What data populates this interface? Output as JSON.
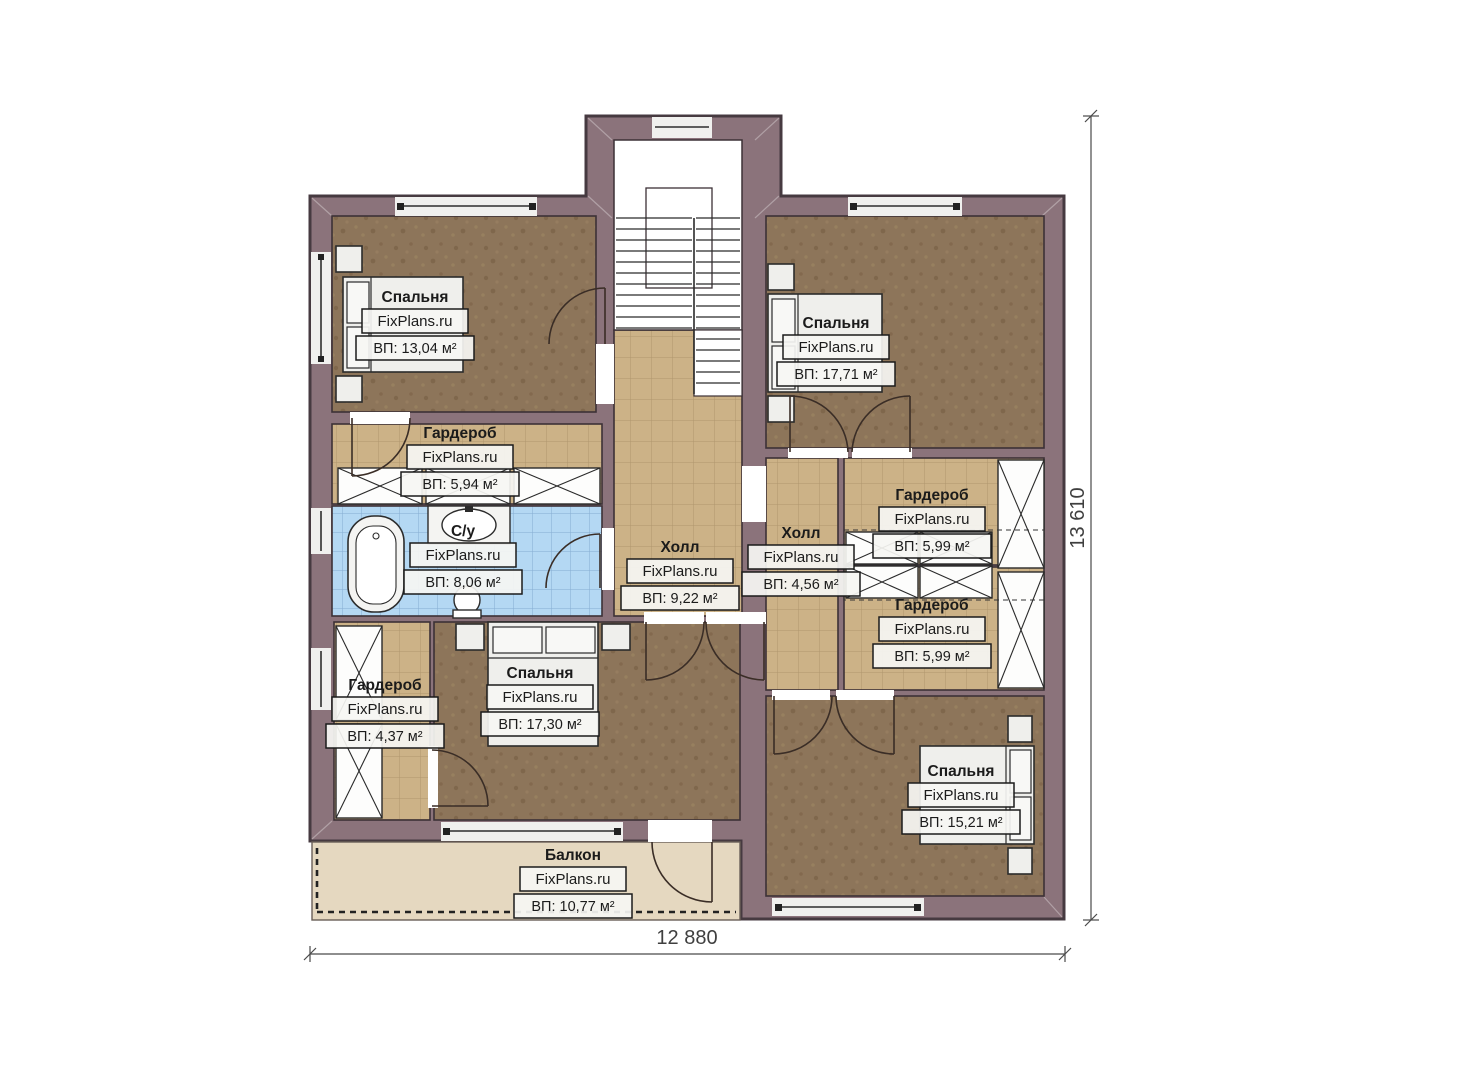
{
  "plan": {
    "brand": "FixPlans.ru",
    "dimensions": {
      "width_label": "12 880",
      "height_label": "13 610"
    },
    "rooms": [
      {
        "id": "bedroom-top-left",
        "name": "Спальня",
        "area": "ВП: 13,04 м²"
      },
      {
        "id": "wardrobe-left",
        "name": "Гардероб",
        "area": "ВП: 5,94 м²"
      },
      {
        "id": "bathroom",
        "name": "С/у",
        "area": "ВП: 8,06 м²"
      },
      {
        "id": "hall-center",
        "name": "Холл",
        "area": "ВП: 9,22 м²"
      },
      {
        "id": "hall-right",
        "name": "Холл",
        "area": "ВП: 4,56 м²"
      },
      {
        "id": "wardrobe-right-upper",
        "name": "Гардероб",
        "area": "ВП: 5,99 м²"
      },
      {
        "id": "wardrobe-right-lower",
        "name": "Гардероб",
        "area": "ВП: 5,99 м²"
      },
      {
        "id": "bedroom-top-right",
        "name": "Спальня",
        "area": "ВП: 17,71 м²"
      },
      {
        "id": "wardrobe-bottom-left",
        "name": "Гардероб",
        "area": "ВП: 4,37 м²"
      },
      {
        "id": "bedroom-bottom-center",
        "name": "Спальня",
        "area": "ВП: 17,30 м²"
      },
      {
        "id": "bedroom-bottom-right",
        "name": "Спальня",
        "area": "ВП: 15,21 м²"
      },
      {
        "id": "balcony",
        "name": "Балкон",
        "area": "ВП: 10,77 м²"
      }
    ]
  }
}
